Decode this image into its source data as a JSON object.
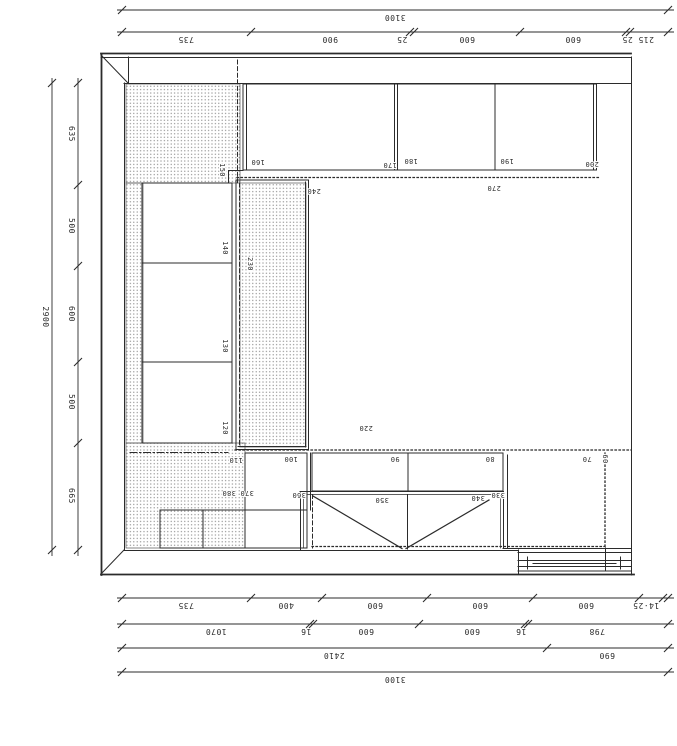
{
  "colors": {
    "line": "#2b2b2b",
    "stipple_dot": "#7d7d7d",
    "background": "#ffffff"
  },
  "dimensions": [
    {
      "id": "top-overall",
      "axis": "h",
      "pos": 10,
      "from": 122,
      "to": 668,
      "ticks": [
        122,
        668
      ],
      "labels": [
        {
          "t": "3100",
          "at": 395
        }
      ]
    },
    {
      "id": "top-segments",
      "axis": "h",
      "pos": 32,
      "from": 122,
      "to": 668,
      "ticks": [
        122,
        251,
        410,
        414,
        520,
        626,
        630,
        668
      ],
      "labels": [
        {
          "t": "735",
          "at": 186
        },
        {
          "t": "900",
          "at": 330
        },
        {
          "t": "25",
          "at": 402
        },
        {
          "t": "600",
          "at": 467
        },
        {
          "t": "600",
          "at": 573
        },
        {
          "t": "215 25",
          "at": 638
        }
      ]
    },
    {
      "id": "left-overall",
      "axis": "v",
      "pos": 52,
      "from": 83,
      "to": 550,
      "ticks": [
        83,
        550
      ],
      "labels": [
        {
          "t": "2900",
          "at": 317
        }
      ]
    },
    {
      "id": "left-segments",
      "axis": "v",
      "pos": 78,
      "from": 83,
      "to": 550,
      "ticks": [
        83,
        185,
        266,
        362,
        443,
        550
      ],
      "labels": [
        {
          "t": "635",
          "at": 134
        },
        {
          "t": "500",
          "at": 226
        },
        {
          "t": "600",
          "at": 314
        },
        {
          "t": "500",
          "at": 402
        },
        {
          "t": "665",
          "at": 496
        }
      ]
    },
    {
      "id": "bottom-row1",
      "axis": "h",
      "pos": 598,
      "from": 122,
      "to": 668,
      "ticks": [
        122,
        251,
        322,
        427,
        533,
        639,
        663,
        668
      ],
      "labels": [
        {
          "t": "735",
          "at": 186
        },
        {
          "t": "400",
          "at": 286
        },
        {
          "t": "600",
          "at": 375
        },
        {
          "t": "600",
          "at": 480
        },
        {
          "t": "600",
          "at": 586
        },
        {
          "t": "14·25",
          "at": 646
        }
      ]
    },
    {
      "id": "bottom-row2",
      "axis": "h",
      "pos": 624,
      "from": 122,
      "to": 668,
      "ticks": [
        122,
        310,
        313,
        419,
        525,
        528,
        668
      ],
      "labels": [
        {
          "t": "1070",
          "at": 216
        },
        {
          "t": "16",
          "at": 306
        },
        {
          "t": "600",
          "at": 366
        },
        {
          "t": "600",
          "at": 472
        },
        {
          "t": "16",
          "at": 521
        },
        {
          "t": "798",
          "at": 597
        }
      ]
    },
    {
      "id": "bottom-row3",
      "axis": "h",
      "pos": 648,
      "from": 122,
      "to": 668,
      "ticks": [
        122,
        547,
        668
      ],
      "labels": [
        {
          "t": "2410",
          "at": 334
        },
        {
          "t": "690",
          "at": 607
        }
      ]
    },
    {
      "id": "bottom-row4",
      "axis": "h",
      "pos": 672,
      "from": 122,
      "to": 668,
      "ticks": [
        122,
        668
      ],
      "labels": [
        {
          "t": "3100",
          "at": 395
        }
      ]
    }
  ],
  "plan_labels": [
    {
      "t": "160",
      "x": 258,
      "y": 163,
      "r": 180
    },
    {
      "t": "170",
      "x": 390,
      "y": 166,
      "r": 180
    },
    {
      "t": "180",
      "x": 411,
      "y": 162,
      "r": 180
    },
    {
      "t": "190",
      "x": 507,
      "y": 162,
      "r": 180
    },
    {
      "t": "200",
      "x": 592,
      "y": 165,
      "r": 180
    },
    {
      "t": "240",
      "x": 314,
      "y": 192,
      "r": 180
    },
    {
      "t": "270",
      "x": 494,
      "y": 189,
      "r": 180
    },
    {
      "t": "150",
      "x": 223,
      "y": 170,
      "r": 90
    },
    {
      "t": "140",
      "x": 226,
      "y": 248,
      "r": 90
    },
    {
      "t": "130",
      "x": 226,
      "y": 346,
      "r": 90
    },
    {
      "t": "120",
      "x": 226,
      "y": 428,
      "r": 90
    },
    {
      "t": "230",
      "x": 251,
      "y": 264,
      "r": 90
    },
    {
      "t": "220",
      "x": 366,
      "y": 429,
      "r": 180
    },
    {
      "t": "110",
      "x": 236,
      "y": 461,
      "r": 180
    },
    {
      "t": "100",
      "x": 291,
      "y": 460,
      "r": 180
    },
    {
      "t": "90",
      "x": 395,
      "y": 460,
      "r": 180
    },
    {
      "t": "80",
      "x": 490,
      "y": 460,
      "r": 180
    },
    {
      "t": "70",
      "x": 587,
      "y": 460,
      "r": 180
    },
    {
      "t": "60",
      "x": 606,
      "y": 459,
      "r": 90
    },
    {
      "t": "380",
      "x": 229,
      "y": 494,
      "r": 180
    },
    {
      "t": "370",
      "x": 247,
      "y": 494,
      "r": 180
    },
    {
      "t": "360",
      "x": 299,
      "y": 496,
      "r": 180
    },
    {
      "t": "350",
      "x": 382,
      "y": 501,
      "r": 180
    },
    {
      "t": "340",
      "x": 478,
      "y": 499,
      "r": 180
    },
    {
      "t": "330",
      "x": 498,
      "y": 496,
      "r": 180
    }
  ]
}
